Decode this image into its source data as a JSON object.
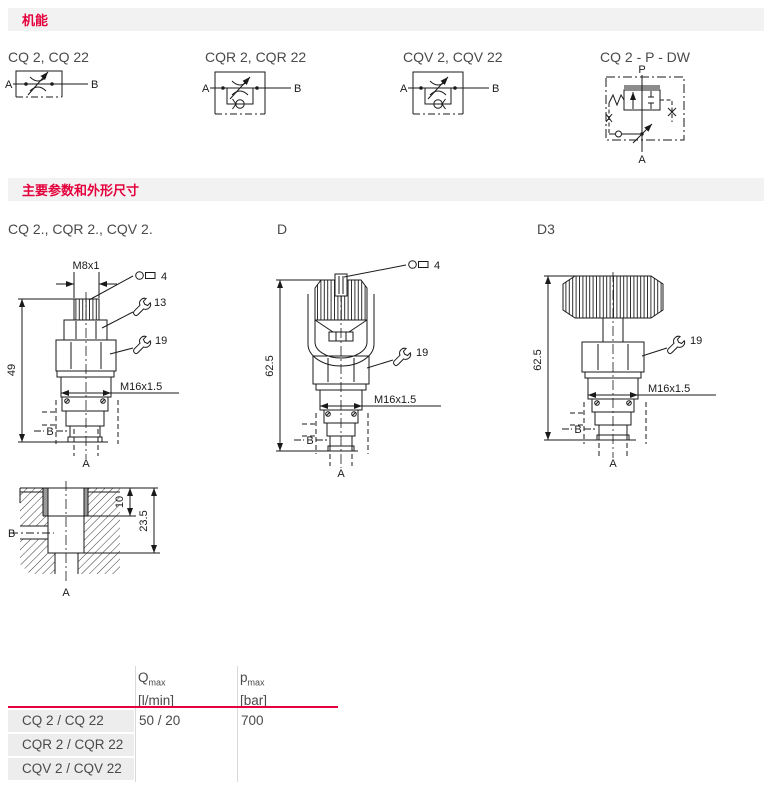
{
  "colors": {
    "accent": "#e4003c",
    "strip_bg": "#f2f2f2",
    "row_bg": "#ededed",
    "text": "#4a4a4a",
    "line": "#1a1a1a"
  },
  "icons": {
    "hex_key": "allen-key",
    "wrench": "open-end-wrench"
  },
  "sections": {
    "function": "机能",
    "params": "主要参数和外形尺寸"
  },
  "symbols": [
    {
      "title": "CQ 2, CQ 22",
      "port_left": "A",
      "port_right": "B"
    },
    {
      "title": "CQR 2, CQR 22",
      "port_left": "A",
      "port_right": "B"
    },
    {
      "title": "CQV 2, CQV 22",
      "port_left": "A",
      "port_right": "B"
    },
    {
      "title": "CQ 2 - P - DW",
      "port_top": "P",
      "port_bottom": "A"
    }
  ],
  "drawings": {
    "cq2": {
      "title": "CQ 2., CQR 2., CQV 2.",
      "thread_top": "M8x1",
      "hex_key": "4",
      "wrench_small": "13",
      "wrench_large": "19",
      "height": "49",
      "thread": "M16x1.5",
      "port_b": "B",
      "port_a": "A"
    },
    "d": {
      "title": "D",
      "hex_key": "4",
      "wrench": "19",
      "height": "62.5",
      "thread": "M16x1.5",
      "port_b": "B",
      "port_a": "A"
    },
    "d3": {
      "title": "D3",
      "wrench": "19",
      "height": "62.5",
      "thread": "M16x1.5",
      "port_b": "B",
      "port_a": "A"
    },
    "cavity": {
      "depth1": "10",
      "depth2": "23.5",
      "port_b": "B",
      "port_a": "A"
    }
  },
  "table": {
    "headers": {
      "q_symbol": "Q",
      "q_sub": "max",
      "q_unit": "[l/min]",
      "p_symbol": "p",
      "p_sub": "max",
      "p_unit": "[bar]"
    },
    "rows": [
      {
        "label": "CQ 2 / CQ 22",
        "qmax": "50 / 20",
        "pmax": "700"
      },
      {
        "label": "CQR 2 / CQR 22",
        "qmax": "",
        "pmax": ""
      },
      {
        "label": "CQV 2 / CQV 22",
        "qmax": "",
        "pmax": ""
      }
    ]
  }
}
